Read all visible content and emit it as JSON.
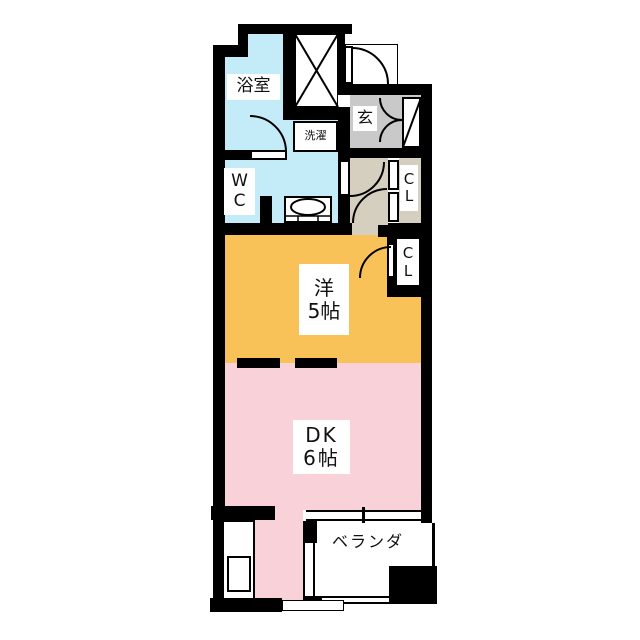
{
  "document": {
    "type": "apartment-floor-plan"
  },
  "colors": {
    "wall": "#000000",
    "bathroom_blue": "#c4ebf8",
    "entrance_gray": "#c9c9c9",
    "hall_beige": "#d5cfc0",
    "western_room_orange": "#f9c258",
    "dining_kitchen_pink": "#f8d2d8",
    "background": "#ffffff"
  },
  "rooms": {
    "bathroom": {
      "label": "浴室"
    },
    "laundry": {
      "label": "洗濯"
    },
    "entrance": {
      "label": "玄"
    },
    "wc": {
      "lines": [
        "W",
        "C"
      ]
    },
    "closet_hall": {
      "lines": [
        "C",
        "L"
      ]
    },
    "closet_western": {
      "lines": [
        "C",
        "L"
      ]
    },
    "western_room": {
      "lines": [
        "洋",
        "5帖"
      ]
    },
    "dining_kitchen": {
      "lines": [
        "DK",
        "6帖"
      ]
    },
    "balcony": {
      "label": "ベランダ"
    }
  }
}
